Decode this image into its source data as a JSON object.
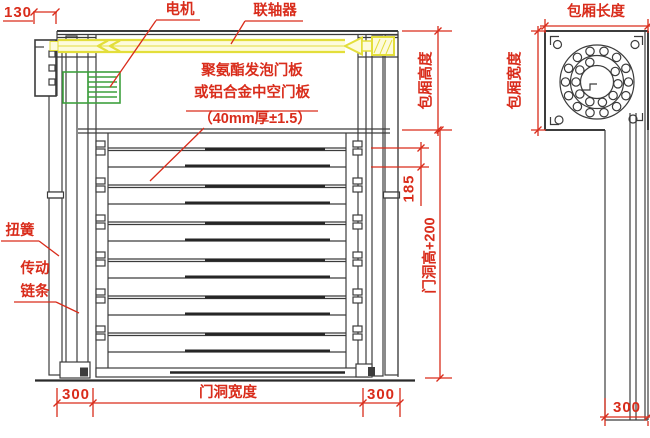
{
  "drawing_type": "roller-shutter-door-technical-drawing",
  "part_labels": {
    "motor": "电机",
    "coupling": "联轴器",
    "panel_spec": [
      "聚氨酯发泡门板",
      "或铝合金中空门板",
      "（40mm厚±1.5）"
    ],
    "torsion_spring": "扭簧",
    "drive_chain": [
      "传动",
      "链条"
    ]
  },
  "dimensions": {
    "bracket_width": "130",
    "bottom_left_300": "300",
    "door_opening_width": "门洞宽度",
    "bottom_right_300": "300",
    "box_height": "包厢高度",
    "dim_185": "185",
    "door_opening_height_plus": "门洞高+200",
    "box_length": "包厢长度",
    "box_width": "包厢宽度",
    "side_bottom_300": "300"
  },
  "colors": {
    "annotation_red": "#d92c1b",
    "line_dark": "#3c3c3c",
    "shaft_yellow": "#e3de3b",
    "motor_green": "#3da03d",
    "background": "#ffffff"
  }
}
